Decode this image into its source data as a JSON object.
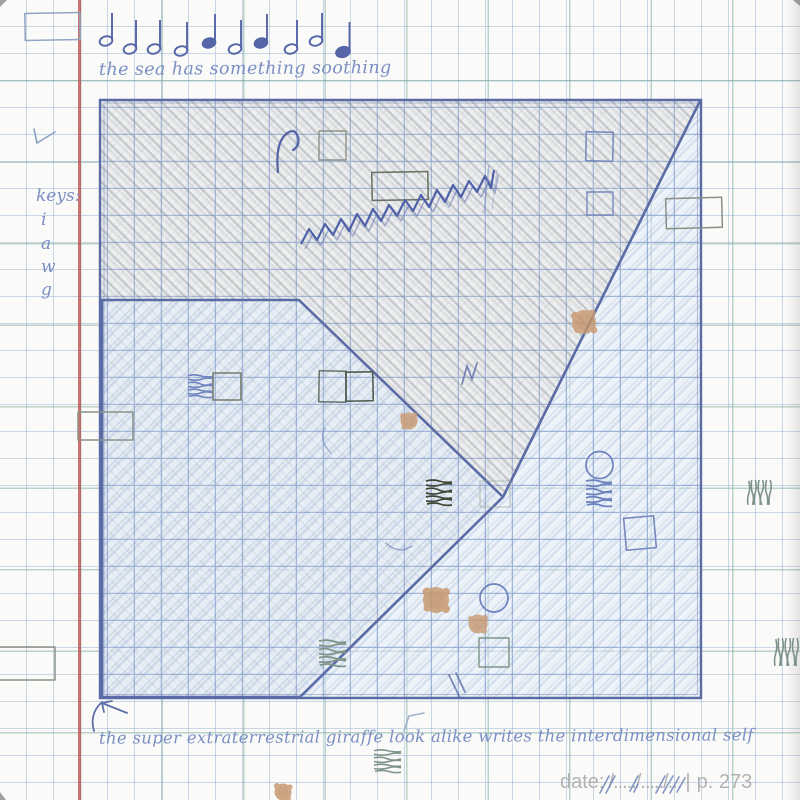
{
  "page": {
    "kind": "notebook-sketch-page",
    "paper_color": "#fafaf8",
    "grid_blue": "#80a0ca",
    "grid_teal": "#7aaa9e",
    "margin_line_color": "#c05550",
    "handwriting_color": "#7b8fc5",
    "sketch_blue": "#5b6ba6",
    "pencil_gray": "#ababab",
    "stain_color": "#c99a72",
    "print_gray": "#b2b2b2"
  },
  "header": {
    "melody_caption": "the sea has something soothing",
    "music_notes_count": 10
  },
  "sidebar": {
    "keys_label": "keys:",
    "keys": [
      "i",
      "a",
      "w",
      "g"
    ]
  },
  "footer": {
    "caption": "the super extraterrestrial giraffe look alike writes the interdimensional self",
    "date_label": "date:",
    "date_dots": "/...../...../...",
    "divider": "|",
    "page_label": "p. 273"
  }
}
